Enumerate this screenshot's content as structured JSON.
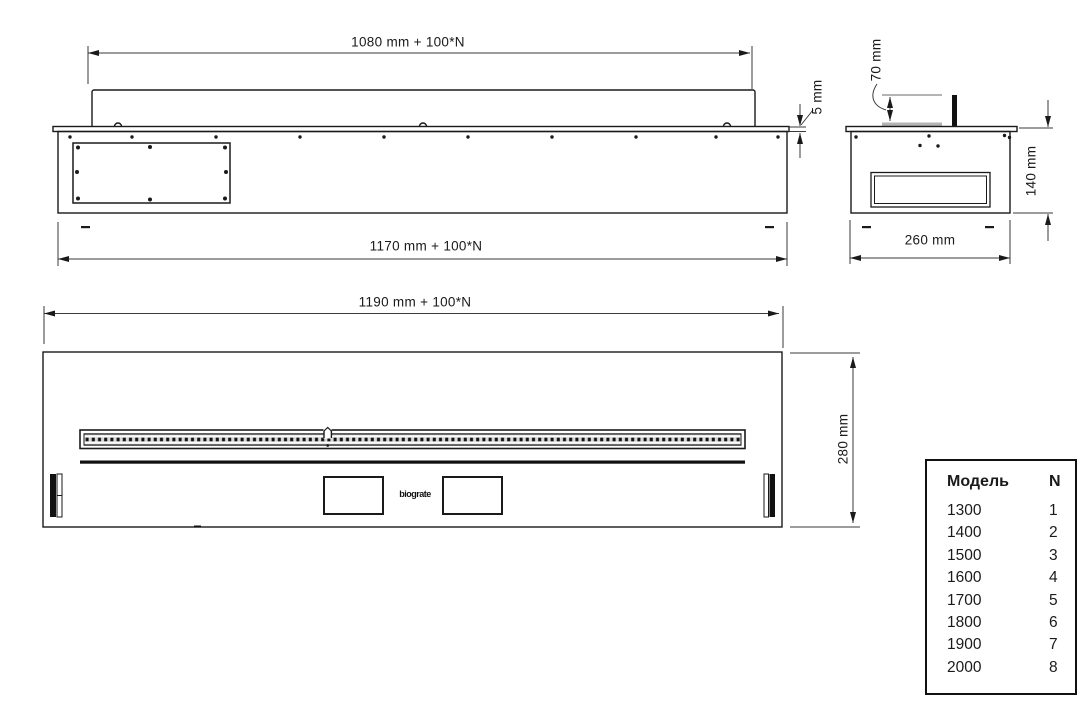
{
  "drawing": {
    "front_view": {
      "dim_length_top": "1080 mm + 100*N",
      "dim_length_bottom": "1170 mm + 100*N",
      "dim_plate_thickness": "5 mm"
    },
    "side_view": {
      "dim_burner_offset": "70 mm",
      "dim_height": "140 mm",
      "dim_depth": "260 mm"
    },
    "plan_view": {
      "dim_length": "1190 mm + 100*N",
      "dim_depth": "280 mm",
      "logo": "biograte"
    }
  },
  "model_table": {
    "header": {
      "model": "Модель",
      "n": "N"
    },
    "rows": [
      {
        "model": "1300",
        "n": "1"
      },
      {
        "model": "1400",
        "n": "2"
      },
      {
        "model": "1500",
        "n": "3"
      },
      {
        "model": "1600",
        "n": "4"
      },
      {
        "model": "1700",
        "n": "5"
      },
      {
        "model": "1800",
        "n": "6"
      },
      {
        "model": "1900",
        "n": "7"
      },
      {
        "model": "2000",
        "n": "8"
      }
    ]
  },
  "colors": {
    "line": "#1a1a1a",
    "dim_line": "#3a3a3a",
    "lid_gray": "#b4b4b4",
    "background": "#ffffff"
  }
}
